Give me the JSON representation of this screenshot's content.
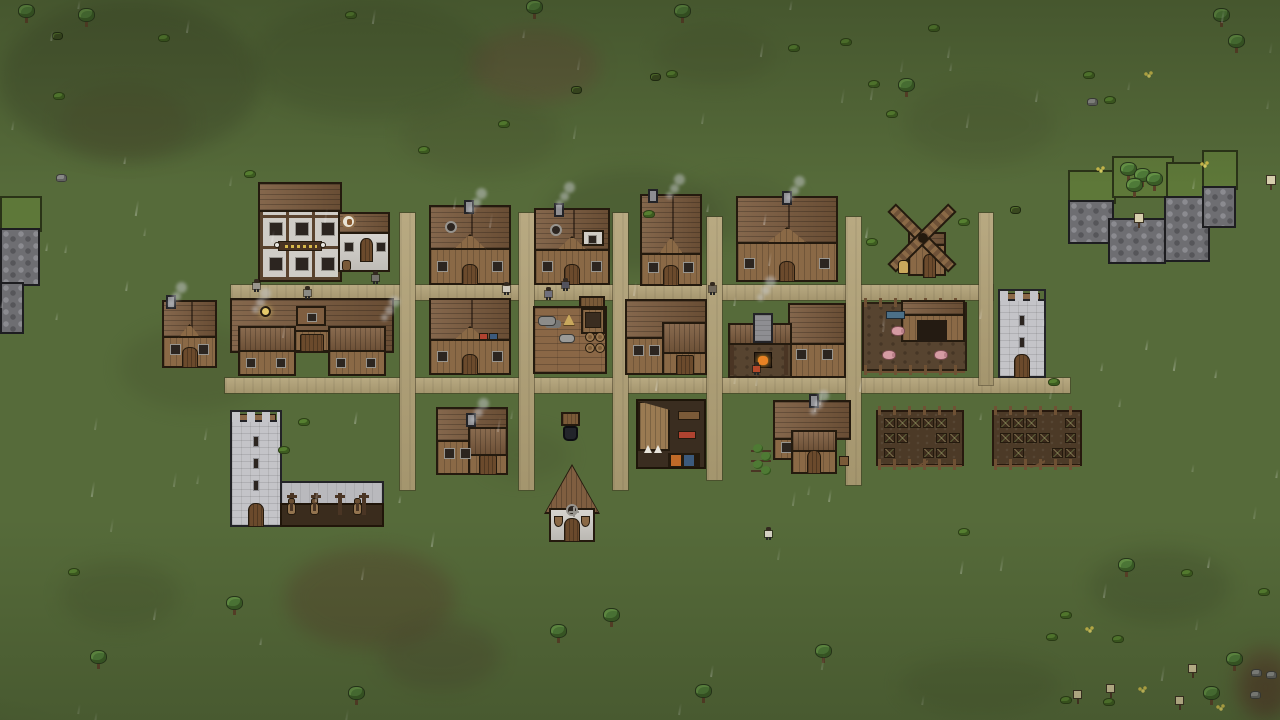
{
  "app": {
    "name": "pixel-village-game",
    "scene": "village-overview-raining"
  },
  "viewport": {
    "width": 1280,
    "height": 720
  },
  "palette": {
    "grass": "#566b3a",
    "road": "#b2a277",
    "roof": "#7a5a3d",
    "wood_wall": "#8a6946",
    "plaster": "#cfccc6",
    "stone": "#c4c4c8",
    "cliff": "#6e6e72",
    "soil": "#4c3a27",
    "fire": "#e88224",
    "smoke": "#c8cacd",
    "pig": "#d59ba3",
    "horse": "#93744f",
    "cloth_red": "#b04330",
    "cloth_blue": "#3c5a7c",
    "trough_blue": "#4c7088",
    "lantern": "#e5c96a",
    "sack": "#c9a85c"
  },
  "ground": {
    "patches": [
      {
        "x": 0,
        "y": 0,
        "w": 260,
        "h": 160,
        "c": "#3e482a",
        "o": 0.4
      },
      {
        "x": 250,
        "y": 0,
        "w": 240,
        "h": 120,
        "c": "#42502c",
        "o": 0.3
      },
      {
        "x": 470,
        "y": 28,
        "w": 130,
        "h": 75,
        "c": "#69493a",
        "o": 0.4
      },
      {
        "x": 400,
        "y": 95,
        "w": 160,
        "h": 80,
        "c": "#4a5530",
        "o": 0.3
      },
      {
        "x": 545,
        "y": 170,
        "w": 180,
        "h": 100,
        "c": "#3f4c2b",
        "o": 0.35
      },
      {
        "x": 655,
        "y": 25,
        "w": 120,
        "h": 60,
        "c": "#4a5530",
        "o": 0.3
      },
      {
        "x": 905,
        "y": 85,
        "w": 150,
        "h": 80,
        "c": "#485430",
        "o": 0.3
      },
      {
        "x": 60,
        "y": 85,
        "w": 130,
        "h": 75,
        "c": "#4a4a2c",
        "o": 0.35
      },
      {
        "x": 120,
        "y": 325,
        "w": 150,
        "h": 85,
        "c": "#46522e",
        "o": 0.3
      },
      {
        "x": 285,
        "y": 548,
        "w": 170,
        "h": 100,
        "c": "#56452e",
        "o": 0.45
      },
      {
        "x": 380,
        "y": 620,
        "w": 120,
        "h": 70,
        "c": "#4d4630",
        "o": 0.35
      },
      {
        "x": 60,
        "y": 560,
        "w": 120,
        "h": 70,
        "c": "#44502c",
        "o": 0.3
      },
      {
        "x": 900,
        "y": 655,
        "w": 160,
        "h": 60,
        "c": "#44502c",
        "o": 0.25
      },
      {
        "x": 1090,
        "y": 548,
        "w": 140,
        "h": 75,
        "c": "#414e2c",
        "o": 0.35
      },
      {
        "x": 1235,
        "y": 645,
        "w": 60,
        "h": 75,
        "c": "#5c4631",
        "o": 0.5
      },
      {
        "x": 1243,
        "y": 660,
        "w": 45,
        "h": 55,
        "c": "#4f3b28",
        "o": 0.6
      },
      {
        "x": 680,
        "y": 175,
        "w": 120,
        "h": 65,
        "c": "#465230",
        "o": 0.25
      },
      {
        "x": 480,
        "y": 430,
        "w": 90,
        "h": 50,
        "c": "#46522e",
        "o": 0.25
      }
    ]
  },
  "roads": [
    {
      "id": "main-street-north",
      "x": 231,
      "y": 285,
      "w": 762,
      "h": 15
    },
    {
      "id": "main-street-south",
      "x": 225,
      "y": 378,
      "w": 845,
      "h": 15
    },
    {
      "id": "lane-1",
      "x": 400,
      "y": 213,
      "w": 15,
      "h": 277
    },
    {
      "id": "lane-2",
      "x": 519,
      "y": 213,
      "w": 15,
      "h": 277
    },
    {
      "id": "lane-3",
      "x": 613,
      "y": 213,
      "w": 15,
      "h": 277
    },
    {
      "id": "lane-4",
      "x": 707,
      "y": 217,
      "w": 15,
      "h": 263
    },
    {
      "id": "lane-5",
      "x": 846,
      "y": 217,
      "w": 15,
      "h": 268
    },
    {
      "id": "lane-6",
      "x": 979,
      "y": 213,
      "w": 14,
      "h": 172
    }
  ],
  "cliffs": [
    {
      "id": "west-cliff",
      "blocks": [
        {
          "t": "grass",
          "x": 0,
          "y": 196,
          "w": 42,
          "h": 36
        },
        {
          "t": "rock",
          "x": 0,
          "y": 228,
          "w": 40,
          "h": 58
        },
        {
          "t": "rock",
          "x": 0,
          "y": 282,
          "w": 24,
          "h": 52
        }
      ]
    },
    {
      "id": "east-plateau",
      "blocks": [
        {
          "t": "grass",
          "x": 1068,
          "y": 170,
          "w": 48,
          "h": 34
        },
        {
          "t": "grass",
          "x": 1112,
          "y": 156,
          "w": 62,
          "h": 42
        },
        {
          "t": "grass",
          "x": 1166,
          "y": 162,
          "w": 46,
          "h": 38
        },
        {
          "t": "grass",
          "x": 1202,
          "y": 150,
          "w": 36,
          "h": 40
        },
        {
          "t": "rock",
          "x": 1068,
          "y": 200,
          "w": 46,
          "h": 44
        },
        {
          "t": "rock",
          "x": 1108,
          "y": 218,
          "w": 58,
          "h": 46
        },
        {
          "t": "rock",
          "x": 1164,
          "y": 196,
          "w": 46,
          "h": 66
        },
        {
          "t": "rock",
          "x": 1202,
          "y": 186,
          "w": 34,
          "h": 42
        }
      ]
    }
  ],
  "buildings": [
    {
      "id": "tavern",
      "type": "tavern",
      "x": 258,
      "y": 182,
      "w": 132,
      "h": 100
    },
    {
      "id": "house-north-1",
      "type": "gable",
      "x": 429,
      "y": 205,
      "w": 82,
      "h": 80,
      "chimney": 35,
      "round_win": true
    },
    {
      "id": "house-north-2",
      "type": "gable",
      "x": 534,
      "y": 208,
      "w": 76,
      "h": 77,
      "chimney": 20,
      "dormer": true,
      "round_win": true
    },
    {
      "id": "house-north-3",
      "type": "gable",
      "x": 640,
      "y": 194,
      "w": 62,
      "h": 92,
      "chimney": 8,
      "steep": true
    },
    {
      "id": "house-north-4",
      "type": "gable",
      "x": 736,
      "y": 196,
      "w": 102,
      "h": 86,
      "chimney": 46,
      "wide": true
    },
    {
      "id": "windmill",
      "type": "windmill",
      "x": 880,
      "y": 196,
      "w": 76,
      "h": 80
    },
    {
      "id": "house-west",
      "type": "gable",
      "x": 162,
      "y": 300,
      "w": 55,
      "h": 68,
      "chimney": 4
    },
    {
      "id": "longhouse",
      "type": "longhouse",
      "x": 230,
      "y": 298,
      "w": 164,
      "h": 78
    },
    {
      "id": "house-mid-1",
      "type": "gable",
      "x": 429,
      "y": 298,
      "w": 82,
      "h": 77,
      "goods": true
    },
    {
      "id": "stock-deck",
      "type": "deck",
      "x": 533,
      "y": 300,
      "w": 74,
      "h": 74
    },
    {
      "id": "house-mid-2",
      "type": "lhouse",
      "x": 625,
      "y": 299,
      "w": 82,
      "h": 76
    },
    {
      "id": "smithy",
      "type": "smithy",
      "x": 728,
      "y": 300,
      "w": 118,
      "h": 78
    },
    {
      "id": "pig-pen",
      "type": "pigpen",
      "x": 862,
      "y": 298,
      "w": 105,
      "h": 77
    },
    {
      "id": "east-tower",
      "type": "tower",
      "x": 998,
      "y": 289,
      "w": 48,
      "h": 89
    },
    {
      "id": "west-keep",
      "type": "tower",
      "x": 230,
      "y": 410,
      "w": 52,
      "h": 117,
      "stable": true
    },
    {
      "id": "house-south-1",
      "type": "lhouse",
      "x": 436,
      "y": 407,
      "w": 72,
      "h": 68,
      "chimney": true
    },
    {
      "id": "well-stall",
      "type": "well",
      "x": 561,
      "y": 412,
      "w": 19,
      "h": 29
    },
    {
      "id": "tannery",
      "type": "tannery",
      "x": 636,
      "y": 399,
      "w": 70,
      "h": 70
    },
    {
      "id": "house-garden",
      "type": "garden",
      "x": 747,
      "y": 400,
      "w": 104,
      "h": 74
    },
    {
      "id": "farm-field-1",
      "type": "farm",
      "x": 876,
      "y": 406,
      "w": 88,
      "h": 64,
      "plots": [
        [
          1,
          1,
          1,
          1,
          1,
          0
        ],
        [
          1,
          1,
          0,
          0,
          1,
          1
        ],
        [
          1,
          0,
          0,
          1,
          1,
          0
        ]
      ]
    },
    {
      "id": "farm-field-2",
      "type": "farm",
      "x": 992,
      "y": 406,
      "w": 90,
      "h": 64,
      "plots": [
        [
          1,
          1,
          1,
          0,
          0,
          1
        ],
        [
          1,
          1,
          1,
          1,
          0,
          1
        ],
        [
          0,
          1,
          0,
          0,
          1,
          1
        ]
      ]
    },
    {
      "id": "church",
      "type": "church",
      "x": 546,
      "y": 466,
      "w": 52,
      "h": 76
    }
  ],
  "scatter": [
    {
      "t": "tree",
      "x": 18,
      "y": 4
    },
    {
      "t": "tree",
      "x": 78,
      "y": 8
    },
    {
      "t": "tree",
      "x": 526,
      "y": 0
    },
    {
      "t": "tree",
      "x": 674,
      "y": 4
    },
    {
      "t": "tree",
      "x": 898,
      "y": 78
    },
    {
      "t": "tree",
      "x": 1213,
      "y": 8
    },
    {
      "t": "tree",
      "x": 1228,
      "y": 34
    },
    {
      "t": "tree",
      "x": 226,
      "y": 596
    },
    {
      "t": "tree",
      "x": 348,
      "y": 686
    },
    {
      "t": "tree",
      "x": 550,
      "y": 624
    },
    {
      "t": "tree",
      "x": 603,
      "y": 608
    },
    {
      "t": "tree",
      "x": 695,
      "y": 684
    },
    {
      "t": "tree",
      "x": 815,
      "y": 644
    },
    {
      "t": "tree",
      "x": 1118,
      "y": 558
    },
    {
      "t": "tree",
      "x": 1226,
      "y": 652
    },
    {
      "t": "tree",
      "x": 1203,
      "y": 686
    },
    {
      "t": "tree",
      "x": 90,
      "y": 650
    },
    {
      "t": "tree",
      "x": 1120,
      "y": 162
    },
    {
      "t": "tree",
      "x": 1134,
      "y": 168
    },
    {
      "t": "tree",
      "x": 1146,
      "y": 172
    },
    {
      "t": "tree",
      "x": 1126,
      "y": 178
    },
    {
      "t": "bush",
      "x": 53,
      "y": 92
    },
    {
      "t": "bush",
      "x": 158,
      "y": 34
    },
    {
      "t": "bush",
      "x": 244,
      "y": 170
    },
    {
      "t": "bush",
      "x": 418,
      "y": 146
    },
    {
      "t": "bush",
      "x": 498,
      "y": 120
    },
    {
      "t": "bush",
      "x": 788,
      "y": 44
    },
    {
      "t": "bush",
      "x": 840,
      "y": 38
    },
    {
      "t": "bush",
      "x": 868,
      "y": 80
    },
    {
      "t": "bush",
      "x": 886,
      "y": 110
    },
    {
      "t": "bush",
      "x": 928,
      "y": 24
    },
    {
      "t": "bush",
      "x": 1083,
      "y": 71
    },
    {
      "t": "bush",
      "x": 1104,
      "y": 96
    },
    {
      "t": "bush",
      "x": 345,
      "y": 11
    },
    {
      "t": "bush",
      "x": 298,
      "y": 418
    },
    {
      "t": "bush",
      "x": 278,
      "y": 446
    },
    {
      "t": "bush",
      "x": 68,
      "y": 568
    },
    {
      "t": "bush",
      "x": 958,
      "y": 218
    },
    {
      "t": "bush",
      "x": 1048,
      "y": 378
    },
    {
      "t": "bush",
      "x": 958,
      "y": 528
    },
    {
      "t": "bush",
      "x": 1060,
      "y": 611
    },
    {
      "t": "bush",
      "x": 1181,
      "y": 569
    },
    {
      "t": "bush",
      "x": 1258,
      "y": 588
    },
    {
      "t": "bush",
      "x": 1046,
      "y": 633
    },
    {
      "t": "bush",
      "x": 1060,
      "y": 696
    },
    {
      "t": "bush",
      "x": 1103,
      "y": 698
    },
    {
      "t": "bush",
      "x": 1112,
      "y": 635
    },
    {
      "t": "bush",
      "x": 666,
      "y": 70
    },
    {
      "t": "bush",
      "x": 866,
      "y": 238
    },
    {
      "t": "bush",
      "x": 643,
      "y": 210
    },
    {
      "t": "darkbush",
      "x": 571,
      "y": 86
    },
    {
      "t": "darkbush",
      "x": 650,
      "y": 73
    },
    {
      "t": "darkbush",
      "x": 52,
      "y": 32
    },
    {
      "t": "darkbush",
      "x": 1010,
      "y": 206
    },
    {
      "t": "rock",
      "x": 56,
      "y": 174
    },
    {
      "t": "rock",
      "x": 1087,
      "y": 98
    },
    {
      "t": "rock",
      "x": 1251,
      "y": 669
    },
    {
      "t": "rock",
      "x": 1266,
      "y": 671
    },
    {
      "t": "rock",
      "x": 1250,
      "y": 691
    },
    {
      "t": "flower",
      "x": 1144,
      "y": 71
    },
    {
      "t": "flower",
      "x": 1200,
      "y": 161
    },
    {
      "t": "flower",
      "x": 1096,
      "y": 166
    },
    {
      "t": "flower",
      "x": 1138,
      "y": 686
    },
    {
      "t": "flower",
      "x": 1216,
      "y": 704
    },
    {
      "t": "flower",
      "x": 1085,
      "y": 626
    },
    {
      "t": "sapling",
      "x": 1073,
      "y": 690
    },
    {
      "t": "sapling",
      "x": 1106,
      "y": 684
    },
    {
      "t": "sapling",
      "x": 1188,
      "y": 664
    },
    {
      "t": "sapling",
      "x": 1175,
      "y": 696
    },
    {
      "t": "sign",
      "x": 1134,
      "y": 213
    },
    {
      "t": "sign",
      "x": 1266,
      "y": 175
    }
  ],
  "characters": [
    {
      "id": "villager-1",
      "x": 253,
      "y": 279,
      "shirt": "#98948c"
    },
    {
      "id": "villager-2",
      "x": 304,
      "y": 286,
      "shirt": "#8a8a84"
    },
    {
      "id": "villager-3",
      "x": 372,
      "y": 271,
      "shirt": "#74706a"
    },
    {
      "id": "villager-4",
      "x": 503,
      "y": 282,
      "shirt": "#cfc9bc"
    },
    {
      "id": "villager-5",
      "x": 545,
      "y": 287,
      "shirt": "#6f6f7c"
    },
    {
      "id": "villager-6",
      "x": 562,
      "y": 278,
      "shirt": "#52525c"
    },
    {
      "id": "villager-7",
      "x": 709,
      "y": 282,
      "shirt": "#6e665a"
    },
    {
      "id": "blacksmith",
      "x": 753,
      "y": 362,
      "shirt": "#b5482a"
    },
    {
      "id": "villager-8",
      "x": 765,
      "y": 527,
      "shirt": "#d6d2c6"
    }
  ],
  "animals": [
    {
      "t": "pig",
      "x": 891,
      "y": 326
    },
    {
      "t": "pig",
      "x": 882,
      "y": 350
    },
    {
      "t": "pig",
      "x": 934,
      "y": 350
    },
    {
      "t": "horse",
      "x": 286,
      "y": 498
    },
    {
      "t": "horse",
      "x": 309,
      "y": 498
    },
    {
      "t": "horse",
      "x": 352,
      "y": 498
    }
  ],
  "smoke": [
    {
      "x": 468,
      "y": 190
    },
    {
      "x": 556,
      "y": 184
    },
    {
      "x": 666,
      "y": 176
    },
    {
      "x": 786,
      "y": 178
    },
    {
      "x": 168,
      "y": 284
    },
    {
      "x": 252,
      "y": 290
    },
    {
      "x": 381,
      "y": 298
    },
    {
      "x": 757,
      "y": 278
    },
    {
      "x": 470,
      "y": 400
    },
    {
      "x": 810,
      "y": 392
    }
  ],
  "rain": {
    "count": 95,
    "seed": 7
  }
}
